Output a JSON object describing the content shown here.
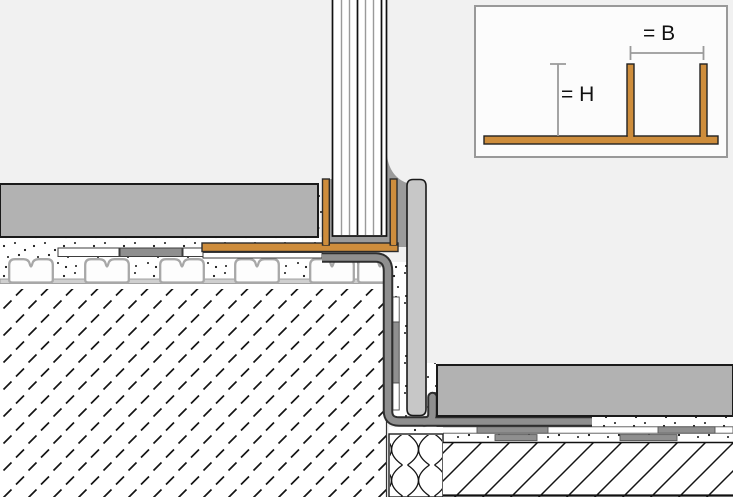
{
  "legend": {
    "width_label": "= B",
    "height_label": "= H"
  },
  "colors": {
    "background": "#F1F1F1",
    "profile_orange": "#CE8D3C",
    "tile_gray": "#B2B2B2",
    "riser_gray": "#C7C7C7",
    "membrane_gray": "#8F8F8F",
    "membrane_outline": "#2E2E2E",
    "sealant_gray": "#9B9B9B",
    "strip_gray": "#8F8F8F",
    "inset_background": "#FCFCFC",
    "inset_border": "#999999",
    "label_color": "#111111"
  }
}
